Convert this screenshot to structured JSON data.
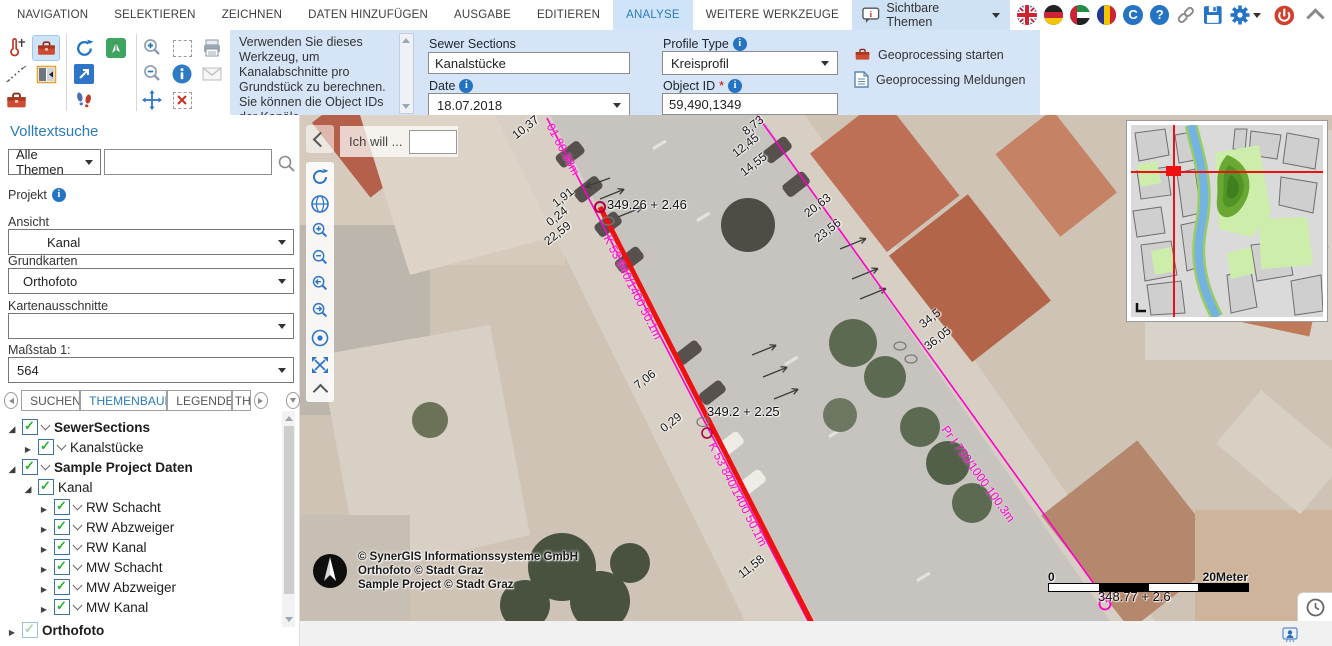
{
  "menu": {
    "items": [
      {
        "label": "NAVIGATION"
      },
      {
        "label": "SELEKTIEREN"
      },
      {
        "label": "ZEICHNEN"
      },
      {
        "label": "DATEN HINZUFÜGEN"
      },
      {
        "label": "AUSGABE"
      },
      {
        "label": "EDITIEREN"
      },
      {
        "label": "ANALYSE"
      },
      {
        "label": "WEITERE WERKZEUGE"
      }
    ]
  },
  "topbar": {
    "visible_themes": "Sichtbare Themen"
  },
  "instruction": {
    "text": "Verwenden Sie dieses Werkzeug, um Kanalabschnitte pro Grundstück zu berechnen. Sie können die Object IDs der Kanäle (Mischwassersystem)"
  },
  "form": {
    "sewer_sections": {
      "label": "Sewer Sections",
      "value": "Kanalstücke"
    },
    "profile_type": {
      "label": "Profile Type",
      "value": "Kreisprofil"
    },
    "date": {
      "label": "Date",
      "value": "18.07.2018"
    },
    "object_id": {
      "label": "Object ID",
      "required": "*",
      "value": "59,490,1349"
    }
  },
  "geoprocessing": {
    "start": "Geoprocessing starten",
    "messages": "Geoprocessing Meldungen"
  },
  "sidebar": {
    "fulltext_title": "Volltextsuche",
    "theme_select": "Alle Themen",
    "project_label": "Projekt",
    "view_label": "Ansicht",
    "view_value": "Kanal",
    "basemap_label": "Grundkarten",
    "basemap_value": "Orthofoto",
    "extents_label": "Kartenausschnitte",
    "scale_label": "Maßstab 1:",
    "scale_value": "564",
    "tabs": [
      {
        "label": "SUCHEN"
      },
      {
        "label": "THEMENBAUM"
      },
      {
        "label": "LEGENDE"
      },
      {
        "label": "THEM"
      }
    ],
    "tree": [
      {
        "label": "SewerSections"
      },
      {
        "label": "Kanalstücke"
      },
      {
        "label": "Sample Project Daten"
      },
      {
        "label": "Kanal"
      },
      {
        "label": "RW Schacht"
      },
      {
        "label": "RW Abzweiger"
      },
      {
        "label": "RW Kanal"
      },
      {
        "label": "MW Schacht"
      },
      {
        "label": "MW Abzweiger"
      },
      {
        "label": "MW Kanal"
      },
      {
        "label": "Orthofoto"
      }
    ]
  },
  "map": {
    "ich_will": "Ich will ...",
    "measure_labels": [
      "10,37",
      "8,73",
      "12,45",
      "14,55",
      "1,91",
      "0,24",
      "22,59",
      "20,63",
      "23,56",
      "34,5",
      "36,05",
      "7,06",
      "0,29",
      "11,58"
    ],
    "elevation_labels": [
      "349.26 + 2.46",
      "349.2 + 2.25",
      "348.77 + 2.6"
    ],
    "pipe_labels": [
      "01 80.38m",
      "K 53 840/1400 50.1m",
      "K 53 840/1400 50.1m",
      "Pr I 750/1000 100.3m"
    ],
    "copyright": [
      "© SynerGIS Informationssysteme GmbH",
      "Orthofoto © Stadt Graz",
      "Sample Project © Stadt Graz"
    ],
    "scalebar": {
      "min": "0",
      "max": "20Meter"
    }
  },
  "colors": {
    "accent": "#2a7ab9",
    "panel_blue": "#d5e5f7",
    "magenta": "#ff00cc",
    "line_red": "#ee1111"
  }
}
